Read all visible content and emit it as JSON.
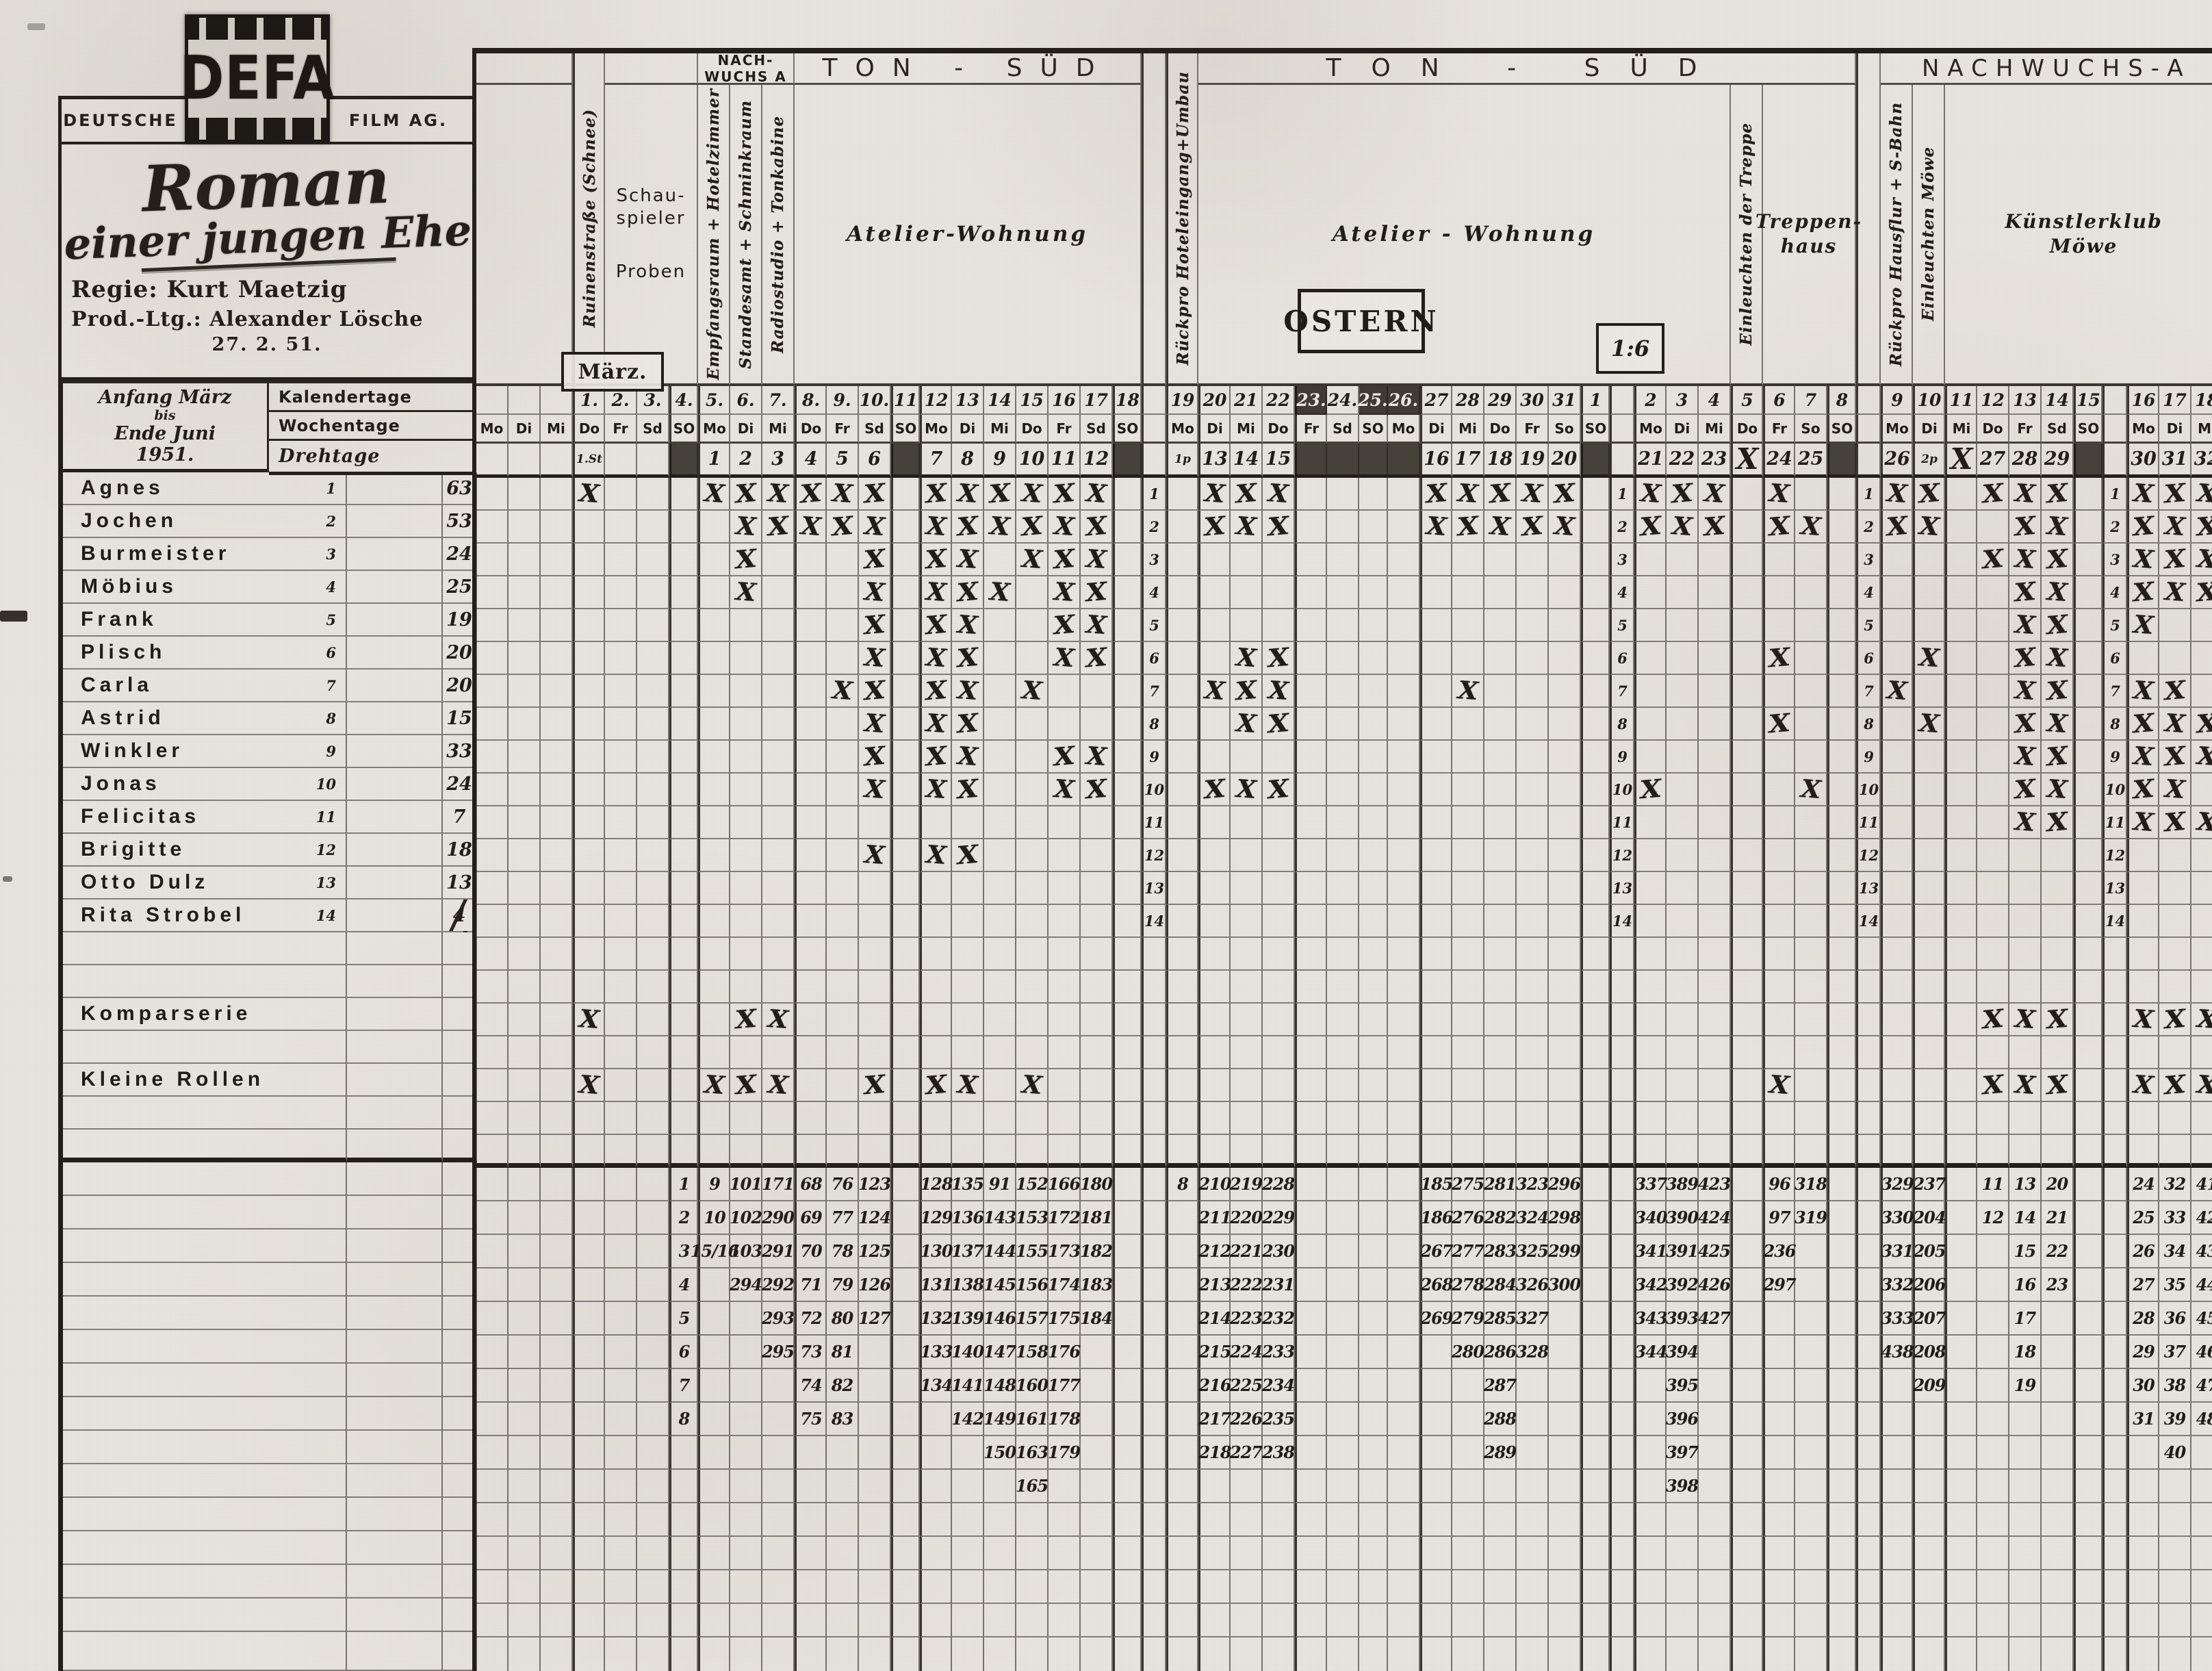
{
  "branding": {
    "deutsche": "DEUTSCHE",
    "defa": "DEFA",
    "film_ag": "FILM AG."
  },
  "production": {
    "title_1": "Roman",
    "title_2": "einer jungen Ehe",
    "regie": "Regie: Kurt Maetzig",
    "prod": "Prod.-Ltg.: Alexander Lösche",
    "date": "27. 2. 51."
  },
  "period": {
    "l1": "Anfang März",
    "l2": "bis",
    "l3": "Ende Juni",
    "l4": "1951."
  },
  "row_headers": {
    "kalendertage": "Kalendertage",
    "wochentage": "Wochentage",
    "drehtage": "Drehtage"
  },
  "annotations": {
    "maerz": "März.",
    "ostern": "OSTERN",
    "ratio": "1:6"
  },
  "band_top": [
    {
      "from": "f26",
      "to": "f28",
      "label": ""
    },
    {
      "from": "m2",
      "to": "m4",
      "label": ""
    },
    {
      "from": "m5",
      "to": "m7",
      "label": "NACH-|WUCHS A",
      "cls": "nbox"
    },
    {
      "from": "m8",
      "to": "m18",
      "label": "TON - SÜD",
      "cls": "big"
    },
    {
      "from": "m20",
      "to": "a8",
      "label": "TON - SÜD",
      "cls": "big big2"
    },
    {
      "from": "a9",
      "to": "a18",
      "label": "NACHWUCHS-A",
      "cls": "big nws"
    }
  ],
  "band_loc": [
    {
      "from": "f26",
      "to": "f28",
      "label": ""
    },
    {
      "from": "m2",
      "to": "m4",
      "label": "Schau-|spieler|Proben",
      "cls": "proben"
    },
    {
      "col": "m5",
      "rot": "Empfangsraum + Hotelzimmer"
    },
    {
      "col": "m6",
      "rot": "Standesamt + Schminkraum"
    },
    {
      "col": "m7",
      "rot": "Radiostudio + Tonkabine"
    },
    {
      "from": "m8",
      "to": "m18",
      "label": "Atelier-Wohnung",
      "cls": "atelier"
    },
    {
      "from": "m20",
      "to": "a4",
      "label": "Atelier - Wohnung",
      "cls": "atelier"
    },
    {
      "col": "a5",
      "rot": "Einleuchten der Treppe"
    },
    {
      "from": "a6",
      "to": "a8",
      "label": "Treppen-|haus",
      "cls": "treppe"
    },
    {
      "col": "a9",
      "rot": "Rückpro Hausflur + S-Bahn"
    },
    {
      "col": "a10",
      "rot": "Einleuchten Möwe"
    },
    {
      "from": "a11",
      "to": "a18",
      "label": "Künstlerklub|Möwe",
      "cls": "klub"
    }
  ],
  "tall_cols": [
    {
      "col": "m1",
      "rot": "Ruinenstraße (Schnee)"
    },
    {
      "col": "m19",
      "rot": "Rückpro Hoteleingang+Umbau"
    },
    {
      "col": "n1",
      "rot": ""
    },
    {
      "col": "n3",
      "rot": ""
    }
  ],
  "columns": [
    {
      "id": "f26",
      "w": "d",
      "kal": "",
      "wo": "Mo",
      "dreh": ""
    },
    {
      "id": "f27",
      "w": "d",
      "kal": "",
      "wo": "Di",
      "dreh": ""
    },
    {
      "id": "f28",
      "w": "d",
      "kal": "",
      "wo": "Mi",
      "dreh": ""
    },
    {
      "id": "m1",
      "w": "d",
      "kal": "1.",
      "wo": "Do",
      "dreh": "1.St",
      "t": 1,
      "sm": 1
    },
    {
      "id": "m2",
      "w": "d",
      "kal": "2.",
      "wo": "Fr",
      "dreh": ""
    },
    {
      "id": "m3",
      "w": "d",
      "kal": "3.",
      "wo": "Sd",
      "dreh": ""
    },
    {
      "id": "m4",
      "w": "so",
      "kal": "4.",
      "wo": "SO",
      "dreh": "",
      "so": 1,
      "t": 1
    },
    {
      "id": "m5",
      "w": "d",
      "kal": "5.",
      "wo": "Mo",
      "dreh": "1",
      "t": 1
    },
    {
      "id": "m6",
      "w": "d",
      "kal": "6.",
      "wo": "Di",
      "dreh": "2"
    },
    {
      "id": "m7",
      "w": "d",
      "kal": "7.",
      "wo": "Mi",
      "dreh": "3"
    },
    {
      "id": "m8",
      "w": "d",
      "kal": "8.",
      "wo": "Do",
      "dreh": "4",
      "t": 1
    },
    {
      "id": "m9",
      "w": "d",
      "kal": "9.",
      "wo": "Fr",
      "dreh": "5"
    },
    {
      "id": "m10",
      "w": "d",
      "kal": "10.",
      "wo": "Sd",
      "dreh": "6"
    },
    {
      "id": "m11",
      "w": "so",
      "kal": "11",
      "wo": "SO",
      "dreh": "",
      "so": 1,
      "t": 1
    },
    {
      "id": "m12",
      "w": "d",
      "kal": "12",
      "wo": "Mo",
      "dreh": "7",
      "t": 1
    },
    {
      "id": "m13",
      "w": "d",
      "kal": "13",
      "wo": "Di",
      "dreh": "8"
    },
    {
      "id": "m14",
      "w": "d",
      "kal": "14",
      "wo": "Mi",
      "dreh": "9"
    },
    {
      "id": "m15",
      "w": "d",
      "kal": "15",
      "wo": "Do",
      "dreh": "10"
    },
    {
      "id": "m16",
      "w": "d",
      "kal": "16",
      "wo": "Fr",
      "dreh": "11"
    },
    {
      "id": "m17",
      "w": "d",
      "kal": "17",
      "wo": "Sd",
      "dreh": "12"
    },
    {
      "id": "m18",
      "w": "so",
      "kal": "18",
      "wo": "SO",
      "dreh": "",
      "so": 1,
      "t": 1
    },
    {
      "id": "n1",
      "w": "n",
      "num": 1,
      "t": 1
    },
    {
      "id": "m19",
      "w": "d",
      "kal": "19",
      "wo": "Mo",
      "dreh": "1p",
      "t": 1,
      "sm": 1
    },
    {
      "id": "m20",
      "w": "d",
      "kal": "20",
      "wo": "Di",
      "dreh": "13",
      "t": 1
    },
    {
      "id": "m21",
      "w": "d",
      "kal": "21",
      "wo": "Mi",
      "dreh": "14"
    },
    {
      "id": "m22",
      "w": "d",
      "kal": "22",
      "wo": "Do",
      "dreh": "15"
    },
    {
      "id": "m23",
      "w": "d",
      "kal": "23.",
      "wo": "Fr",
      "dreh": "",
      "ost": 1,
      "kd": 1,
      "t": 1
    },
    {
      "id": "m24",
      "w": "d",
      "kal": "24.",
      "wo": "Sd",
      "dreh": "",
      "ost": 1
    },
    {
      "id": "m25",
      "w": "so",
      "kal": "25.",
      "wo": "SO",
      "dreh": "",
      "ost": 1,
      "kd": 1
    },
    {
      "id": "m26",
      "w": "d",
      "kal": "26.",
      "wo": "Mo",
      "dreh": "",
      "ost": 1,
      "kd": 1
    },
    {
      "id": "m27",
      "w": "d",
      "kal": "27",
      "wo": "Di",
      "dreh": "16",
      "t": 1
    },
    {
      "id": "m28",
      "w": "d",
      "kal": "28",
      "wo": "Mi",
      "dreh": "17"
    },
    {
      "id": "m29",
      "w": "d",
      "kal": "29",
      "wo": "Do",
      "dreh": "18"
    },
    {
      "id": "m30",
      "w": "d",
      "kal": "30",
      "wo": "Fr",
      "dreh": "19"
    },
    {
      "id": "m31",
      "w": "d",
      "kal": "31",
      "wo": "So",
      "dreh": "20"
    },
    {
      "id": "a1",
      "w": "so",
      "kal": "1",
      "wo": "SO",
      "dreh": "",
      "so": 1,
      "t": 1
    },
    {
      "id": "n2",
      "w": "n",
      "num": 1,
      "t": 1
    },
    {
      "id": "a2",
      "w": "d",
      "kal": "2",
      "wo": "Mo",
      "dreh": "21",
      "t": 1
    },
    {
      "id": "a3",
      "w": "d",
      "kal": "3",
      "wo": "Di",
      "dreh": "22"
    },
    {
      "id": "a4",
      "w": "d",
      "kal": "4",
      "wo": "Mi",
      "dreh": "23"
    },
    {
      "id": "a5",
      "w": "d",
      "kal": "5",
      "wo": "Do",
      "dreh": "X",
      "xd": 1,
      "t": 1
    },
    {
      "id": "a6",
      "w": "d",
      "kal": "6",
      "wo": "Fr",
      "dreh": "24",
      "t": 1
    },
    {
      "id": "a7",
      "w": "d",
      "kal": "7",
      "wo": "So",
      "dreh": "25"
    },
    {
      "id": "a8",
      "w": "so",
      "kal": "8",
      "wo": "SO",
      "dreh": "",
      "so": 1,
      "t": 1
    },
    {
      "id": "n3",
      "w": "n",
      "num": 1,
      "t": 1
    },
    {
      "id": "a9",
      "w": "d",
      "kal": "9",
      "wo": "Mo",
      "dreh": "26",
      "t": 1
    },
    {
      "id": "a10",
      "w": "d",
      "kal": "10",
      "wo": "Di",
      "dreh": "2p",
      "t": 1,
      "sm": 1
    },
    {
      "id": "a11",
      "w": "d",
      "kal": "11",
      "wo": "Mi",
      "dreh": "X",
      "xd": 1,
      "t": 1
    },
    {
      "id": "a12",
      "w": "d",
      "kal": "12",
      "wo": "Do",
      "dreh": "27"
    },
    {
      "id": "a13",
      "w": "d",
      "kal": "13",
      "wo": "Fr",
      "dreh": "28"
    },
    {
      "id": "a14",
      "w": "d",
      "kal": "14",
      "wo": "Sd",
      "dreh": "29"
    },
    {
      "id": "a15",
      "w": "so",
      "kal": "15",
      "wo": "SO",
      "dreh": "",
      "so": 1,
      "t": 1
    },
    {
      "id": "n4",
      "w": "n",
      "num": 1,
      "t": 1
    },
    {
      "id": "a16",
      "w": "d",
      "kal": "16",
      "wo": "Mo",
      "dreh": "30",
      "t": 1
    },
    {
      "id": "a17",
      "w": "d",
      "kal": "17",
      "wo": "Di",
      "dreh": "31"
    },
    {
      "id": "a18",
      "w": "d",
      "kal": "18",
      "wo": "Mi",
      "dreh": "32"
    }
  ],
  "actors": [
    {
      "num": "1",
      "name": "Agnes",
      "count": "63",
      "marks": [
        "m1",
        "m5",
        "m6",
        "m7",
        "m8",
        "m9",
        "m10",
        "m12",
        "m13",
        "m14",
        "m15",
        "m16",
        "m17",
        "m20",
        "m21",
        "m22",
        "m27",
        "m28",
        "m29",
        "m30",
        "m31",
        "a2",
        "a3",
        "a4",
        "a6",
        "a9",
        "a10",
        "a12",
        "a13",
        "a14",
        "a16",
        "a17",
        "a18"
      ]
    },
    {
      "num": "2",
      "name": "Jochen",
      "count": "53",
      "marks": [
        "m6",
        "m7",
        "m8",
        "m9",
        "m10",
        "m12",
        "m13",
        "m14",
        "m15",
        "m16",
        "m17",
        "m20",
        "m21",
        "m22",
        "m27",
        "m28",
        "m29",
        "m30",
        "m31",
        "a2",
        "a3",
        "a4",
        "a6",
        "a7",
        "a9",
        "a10",
        "a13",
        "a14",
        "a16",
        "a17",
        "a18"
      ]
    },
    {
      "num": "3",
      "name": "Burmeister",
      "count": "24",
      "marks": [
        "m6",
        "m10",
        "m12",
        "m13",
        "m15",
        "m16",
        "m17",
        "a12",
        "a13",
        "a14",
        "a16",
        "a17",
        "a18"
      ]
    },
    {
      "num": "4",
      "name": "Möbius",
      "count": "25",
      "marks": [
        "m6",
        "m10",
        "m12",
        "m13",
        "m14",
        "m16",
        "m17",
        "a13",
        "a14",
        "a16",
        "a17",
        "a18"
      ]
    },
    {
      "num": "5",
      "name": "Frank",
      "count": "19",
      "marks": [
        "m10",
        "m12",
        "m13",
        "m16",
        "m17",
        "a13",
        "a14",
        "a16"
      ]
    },
    {
      "num": "6",
      "name": "Plisch",
      "count": "20",
      "marks": [
        "m10",
        "m12",
        "m13",
        "m16",
        "m17",
        "m21",
        "m22",
        "a6",
        "a10",
        "a13",
        "a14"
      ]
    },
    {
      "num": "7",
      "name": "Carla",
      "count": "20",
      "marks": [
        "m9",
        "m10",
        "m12",
        "m13",
        "m15",
        "m20",
        "m21",
        "m22",
        "m28",
        "a9",
        "a13",
        "a14",
        "a16",
        "a17"
      ]
    },
    {
      "num": "8",
      "name": "Astrid",
      "count": "15",
      "marks": [
        "m10",
        "m12",
        "m13",
        "m21",
        "m22",
        "a6",
        "a10",
        "a13",
        "a14",
        "a16",
        "a17",
        "a18"
      ]
    },
    {
      "num": "9",
      "name": "Winkler",
      "count": "33",
      "marks": [
        "m10",
        "m12",
        "m13",
        "m16",
        "m17",
        "a13",
        "a14",
        "a16",
        "a17",
        "a18"
      ]
    },
    {
      "num": "10",
      "name": "Jonas",
      "count": "24",
      "marks": [
        "m10",
        "m12",
        "m13",
        "m16",
        "m17",
        "m20",
        "m21",
        "m22",
        "a2",
        "a7",
        "a13",
        "a14",
        "a16",
        "a17"
      ]
    },
    {
      "num": "11",
      "name": "Felicitas",
      "count": "7",
      "marks": [
        "a13",
        "a14",
        "a16",
        "a17",
        "a18"
      ]
    },
    {
      "num": "12",
      "name": "Brigitte",
      "count": "18",
      "marks": [
        "m10",
        "m12",
        "m13"
      ]
    },
    {
      "num": "13",
      "name": "Otto Dulz",
      "count": "13",
      "marks": []
    },
    {
      "num": "14",
      "name": "Rita Strobel",
      "count": "4",
      "slash": 1,
      "marks": []
    }
  ],
  "extra_rows": [
    {
      "name": "Komparserie",
      "marks": [
        "m1",
        "m6",
        "m7",
        "a12",
        "a13",
        "a14",
        "a16",
        "a17",
        "a18"
      ]
    },
    {
      "name": "Kleine Rollen",
      "marks": [
        "m1",
        "m5",
        "m6",
        "m7",
        "m10",
        "m12",
        "m13",
        "m15",
        "a6",
        "a12",
        "a13",
        "a14",
        "a16",
        "a17",
        "a18"
      ]
    }
  ],
  "scenes": {
    "m4": [
      "1",
      "2",
      "3",
      "4",
      "5",
      "6",
      "7",
      "8"
    ],
    "m5": [
      "9",
      "10",
      "15/16"
    ],
    "m6": [
      "101",
      "102",
      "103",
      "294"
    ],
    "m7": [
      "171",
      "290",
      "291",
      "292",
      "293",
      "295"
    ],
    "m8": [
      "68",
      "69",
      "70",
      "71",
      "72",
      "73",
      "74",
      "75"
    ],
    "m9": [
      "76",
      "77",
      "78",
      "79",
      "80",
      "81",
      "82",
      "83"
    ],
    "m10": [
      "123",
      "124",
      "125",
      "126",
      "127"
    ],
    "m12": [
      "128",
      "129",
      "130",
      "131",
      "132",
      "133",
      "134"
    ],
    "m13": [
      "135",
      "136",
      "137",
      "138",
      "139",
      "140",
      "141",
      "142"
    ],
    "m14": [
      "91",
      "143",
      "144",
      "145",
      "146",
      "147",
      "148",
      "149",
      "150"
    ],
    "m15": [
      "152",
      "153",
      "155",
      "156",
      "157",
      "158",
      "160",
      "161",
      "163",
      "165"
    ],
    "m16": [
      "166",
      "172",
      "173",
      "174",
      "175",
      "176",
      "177",
      "178",
      "179"
    ],
    "m17": [
      "180",
      "181",
      "182",
      "183",
      "184"
    ],
    "m19": [
      "8"
    ],
    "m20": [
      "210",
      "211",
      "212",
      "213",
      "214",
      "215",
      "216",
      "217",
      "218"
    ],
    "m21": [
      "219",
      "220",
      "221",
      "222",
      "223",
      "224",
      "225",
      "226",
      "227"
    ],
    "m22": [
      "228",
      "229",
      "230",
      "231",
      "232",
      "233",
      "234",
      "235",
      "238"
    ],
    "m27": [
      "185",
      "186",
      "267",
      "268",
      "269"
    ],
    "m28": [
      "275",
      "276",
      "277",
      "278",
      "279",
      "280"
    ],
    "m29": [
      "281",
      "282",
      "283",
      "284",
      "285",
      "286",
      "287",
      "288",
      "289"
    ],
    "m30": [
      "323",
      "324",
      "325",
      "326",
      "327",
      "328"
    ],
    "m31": [
      "296",
      "298",
      "299",
      "300"
    ],
    "a2": [
      "337",
      "340",
      "341",
      "342",
      "343",
      "344"
    ],
    "a3": [
      "389",
      "390",
      "391",
      "392",
      "393",
      "394",
      "395",
      "396",
      "397",
      "398"
    ],
    "a4": [
      "423",
      "424",
      "425",
      "426",
      "427"
    ],
    "a6": [
      "96",
      "97",
      "236",
      "297"
    ],
    "a7": [
      "318",
      "319"
    ],
    "a9": [
      "329",
      "330",
      "331",
      "332",
      "333",
      "438"
    ],
    "a10": [
      "237",
      "204",
      "205",
      "206",
      "207",
      "208",
      "209"
    ],
    "a12": [
      "11",
      "12"
    ],
    "a13": [
      "13",
      "14",
      "15",
      "16",
      "17",
      "18",
      "19"
    ],
    "a14": [
      "20",
      "21",
      "22",
      "23"
    ],
    "a16": [
      "24",
      "25",
      "26",
      "27",
      "28",
      "29",
      "30",
      "31"
    ],
    "a17": [
      "32",
      "33",
      "34",
      "35",
      "36",
      "37",
      "38",
      "39",
      "40"
    ],
    "a18": [
      "41",
      "42",
      "43",
      "44",
      "45",
      "46",
      "47",
      "48"
    ]
  }
}
